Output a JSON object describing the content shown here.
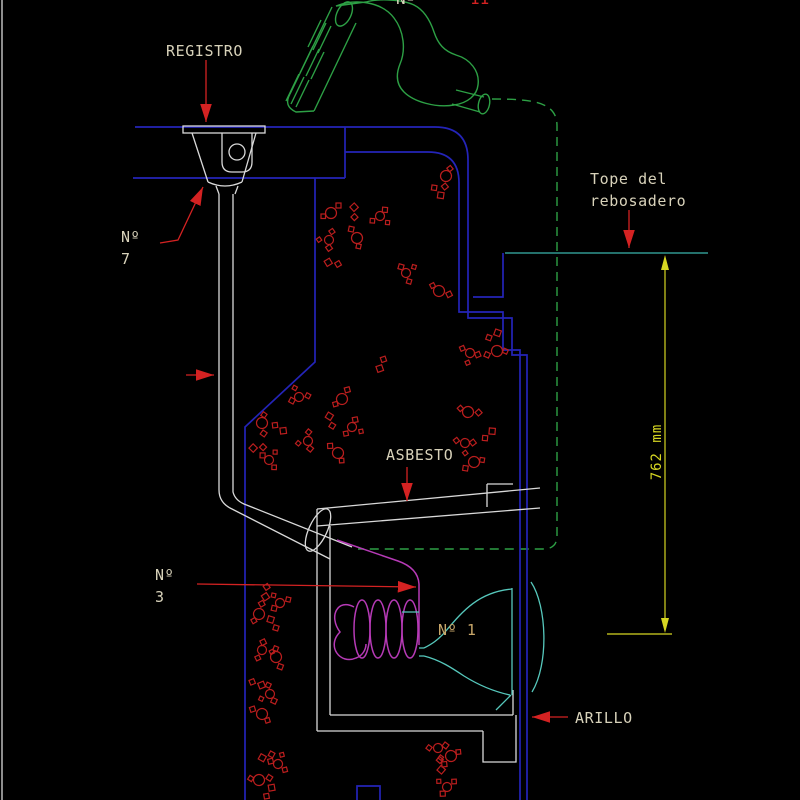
{
  "labels": {
    "registro": "REGISTRO",
    "n7": [
      "Nº",
      "7"
    ],
    "tope_rebosadero": [
      "Tope del",
      "rebosadero"
    ],
    "asbesto": "ASBESTO",
    "n3": [
      "Nº",
      "3"
    ],
    "n1": "Nº 1",
    "arillo": "ARILLO",
    "dimension": "762 mm",
    "top_clipped_white": "Nº",
    "top_clipped_red": "11"
  },
  "colors": {
    "text": "#d8d2ba",
    "gold": "#c8a76a",
    "red": "#d42222",
    "hatch": "#bb1e1e",
    "blue": "#2424b8",
    "green": "#2da045",
    "cyan": "#56c8bc",
    "teal": "#3ab5ad",
    "magenta": "#b63ab6",
    "yellow": "#d6d622",
    "white-line": "#d9d9d9"
  },
  "hatch_marks": [
    [
      331,
      213
    ],
    [
      354,
      210
    ],
    [
      380,
      216
    ],
    [
      446,
      176
    ],
    [
      439,
      193
    ],
    [
      329,
      240
    ],
    [
      357,
      238
    ],
    [
      331,
      263
    ],
    [
      406,
      273
    ],
    [
      439,
      291
    ],
    [
      495,
      334
    ],
    [
      470,
      353
    ],
    [
      497,
      351
    ],
    [
      381,
      366
    ],
    [
      299,
      397
    ],
    [
      342,
      399
    ],
    [
      330,
      419
    ],
    [
      352,
      427
    ],
    [
      262,
      423
    ],
    [
      281,
      429
    ],
    [
      308,
      441
    ],
    [
      338,
      453
    ],
    [
      256,
      448
    ],
    [
      269,
      460
    ],
    [
      468,
      412
    ],
    [
      490,
      433
    ],
    [
      465,
      443
    ],
    [
      474,
      462
    ],
    [
      266,
      594
    ],
    [
      280,
      603
    ],
    [
      259,
      614
    ],
    [
      272,
      622
    ],
    [
      262,
      650
    ],
    [
      276,
      657
    ],
    [
      259,
      684
    ],
    [
      270,
      694
    ],
    [
      262,
      714
    ],
    [
      265,
      757
    ],
    [
      278,
      764
    ],
    [
      259,
      780
    ],
    [
      270,
      790
    ],
    [
      438,
      748
    ],
    [
      451,
      756
    ],
    [
      441,
      767
    ],
    [
      447,
      787
    ]
  ]
}
